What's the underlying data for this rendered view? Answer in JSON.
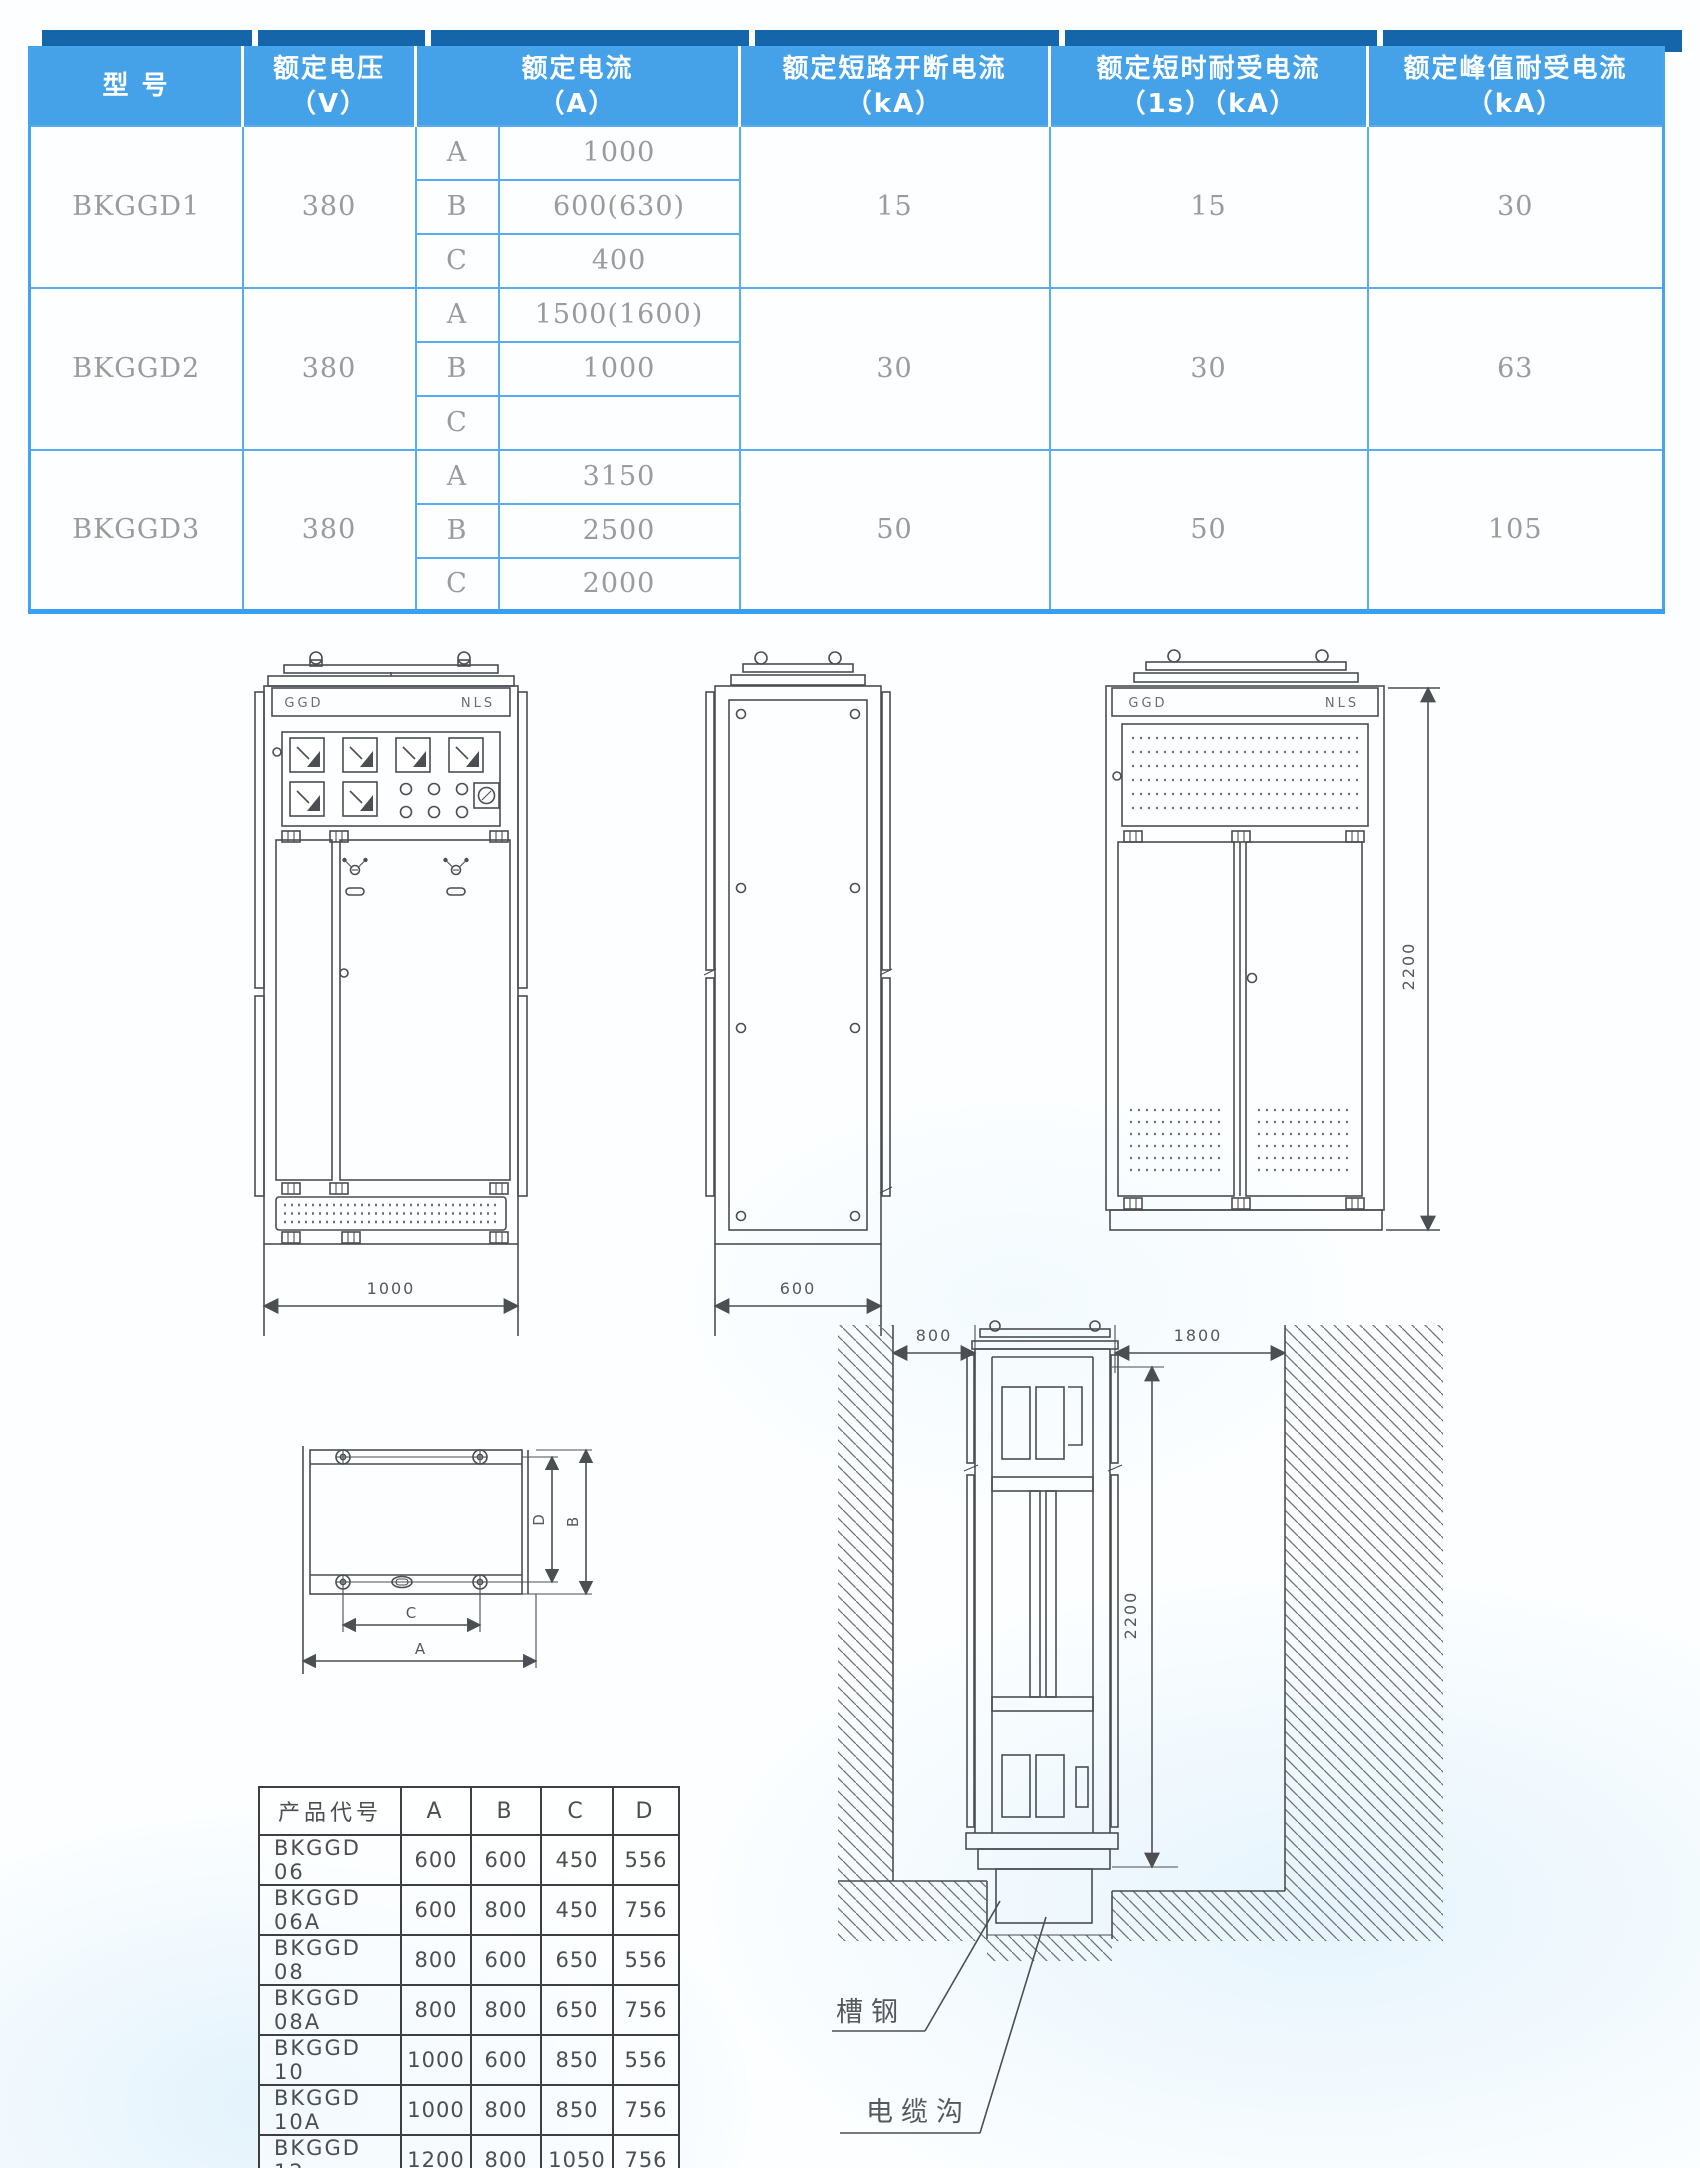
{
  "colors": {
    "header_dark_blue": "#1565ab",
    "header_light_blue": "#45a2e9",
    "table_border_blue": "#58acf2",
    "body_text_gray": "#9b9b9b",
    "drawing_stroke": "#4b4e52"
  },
  "spec_table": {
    "headers": [
      {
        "l1": "型  号",
        "l2": ""
      },
      {
        "l1": "额定电压",
        "l2": "（V）"
      },
      {
        "l1": "额定电流",
        "l2": "（A）"
      },
      {
        "l1": "额定短路开断电流",
        "l2": "（kA）"
      },
      {
        "l1": "额定短时耐受电流",
        "l2": "（1s）（kA）"
      },
      {
        "l1": "额定峰值耐受电流",
        "l2": "（kA）"
      }
    ],
    "rows": [
      {
        "model": "BKGGD1",
        "voltage": "380",
        "sub": [
          {
            "grade": "A",
            "current": "1000"
          },
          {
            "grade": "B",
            "current": "600(630)"
          },
          {
            "grade": "C",
            "current": "400"
          }
        ],
        "breaking": "15",
        "short_time": "15",
        "peak": "30"
      },
      {
        "model": "BKGGD2",
        "voltage": "380",
        "sub": [
          {
            "grade": "A",
            "current": "1500(1600)"
          },
          {
            "grade": "B",
            "current": "1000"
          },
          {
            "grade": "C",
            "current": ""
          }
        ],
        "breaking": "30",
        "short_time": "30",
        "peak": "63"
      },
      {
        "model": "BKGGD3",
        "voltage": "380",
        "sub": [
          {
            "grade": "A",
            "current": "3150"
          },
          {
            "grade": "B",
            "current": "2500"
          },
          {
            "grade": "C",
            "current": "2000"
          }
        ],
        "breaking": "50",
        "short_time": "50",
        "peak": "105"
      }
    ]
  },
  "dim_table": {
    "headers": [
      "产品代号",
      "A",
      "B",
      "C",
      "D"
    ],
    "rows": [
      [
        "BKGGD  06",
        "600",
        "600",
        "450",
        "556"
      ],
      [
        "BKGGD  06A",
        "600",
        "800",
        "450",
        "756"
      ],
      [
        "BKGGD  08",
        "800",
        "600",
        "650",
        "556"
      ],
      [
        "BKGGD  08A",
        "800",
        "800",
        "650",
        "756"
      ],
      [
        "BKGGD  10",
        "1000",
        "600",
        "850",
        "556"
      ],
      [
        "BKGGD  10A",
        "1000",
        "800",
        "850",
        "756"
      ],
      [
        "BKGGD  12",
        "1200",
        "800",
        "1050",
        "756"
      ]
    ]
  },
  "drawings": {
    "front": {
      "nameplate_left": "GGD",
      "nameplate_right": "NLS",
      "width_dim": "1000"
    },
    "side": {
      "width_dim": "600"
    },
    "back": {
      "nameplate_left": "GGD",
      "nameplate_right": "NLS",
      "height_dim": "2200"
    },
    "top_view": {
      "dim_a": "A",
      "dim_b": "B",
      "dim_c": "C",
      "dim_d": "D"
    },
    "installation": {
      "left_clearance": "800",
      "right_clearance": "1800",
      "height_dim": "2200",
      "channel_label": "槽钢",
      "trench_label": "电缆沟"
    }
  }
}
